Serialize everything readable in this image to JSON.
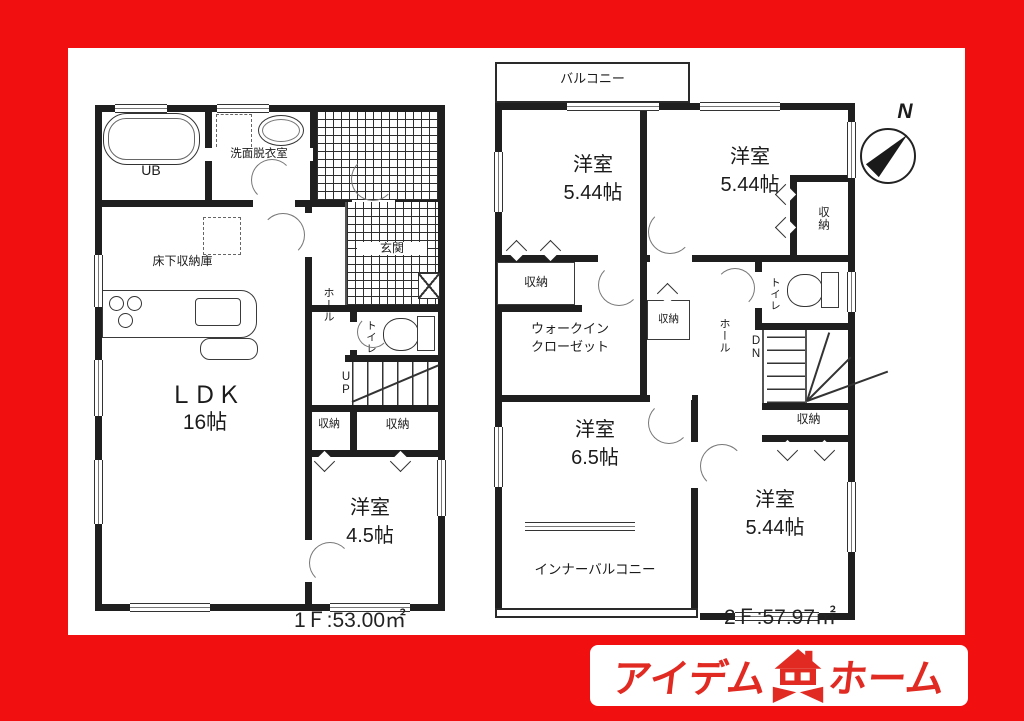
{
  "colors": {
    "frame_red": "#f10f0f",
    "wall_black": "#1f1f1f",
    "logo_red": "#e02a22"
  },
  "floor1": {
    "area_label": "1Ｆ:53.00㎡",
    "rooms": {
      "ub": "UB",
      "washroom": "洗面脱衣室",
      "underfloor_storage": "床下収納庫",
      "ldk_name": "ＬＤＫ",
      "ldk_size": "16帖",
      "hall": "ホール",
      "toilet": "トイレ",
      "up": "UP",
      "genkan": "玄関",
      "closet": "収納",
      "bedroom_name": "洋室",
      "bedroom_size": "4.5帖"
    }
  },
  "floor2": {
    "area_label": "2Ｆ:57.97㎡",
    "rooms": {
      "balcony": "バルコニー",
      "bedroom1_name": "洋室",
      "bedroom1_size": "5.44帖",
      "bedroom2_name": "洋室",
      "bedroom2_size": "5.44帖",
      "closet": "収納",
      "wic_line1": "ウォークイン",
      "wic_line2": "クローゼット",
      "toilet": "トイレ",
      "hall": "ホール",
      "dn": "DN",
      "bedroom3_name": "洋室",
      "bedroom3_size": "6.5帖",
      "bedroom4_name": "洋室",
      "bedroom4_size": "5.44帖",
      "inner_balcony": "インナーバルコニー"
    }
  },
  "compass": {
    "north": "N"
  },
  "logo": {
    "left": "アイデム",
    "right": "ホーム"
  }
}
